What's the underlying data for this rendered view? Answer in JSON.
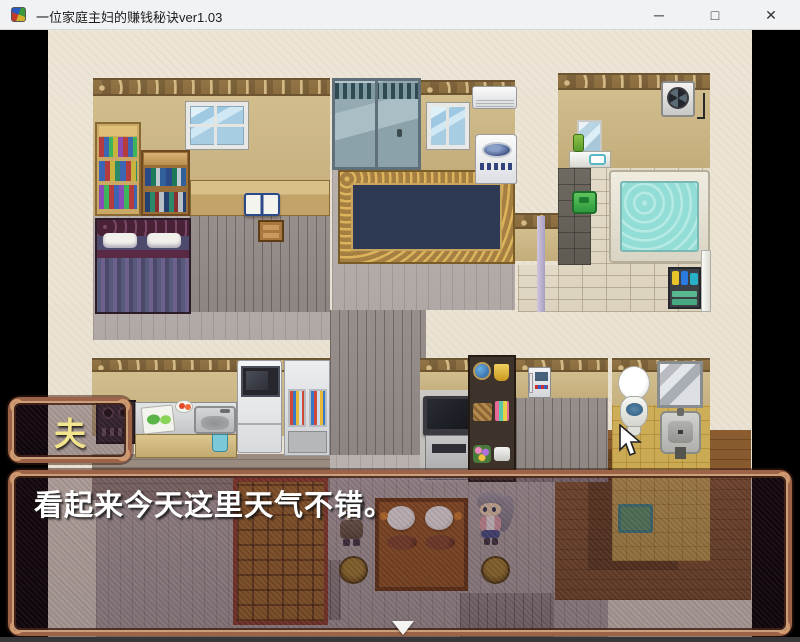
{
  "window": {
    "title": "一位家庭主妇的赚钱秘诀ver1.03",
    "minimize_glyph": "─",
    "maximize_glyph": "□",
    "close_glyph": "✕"
  },
  "dialogue": {
    "speaker": "夫",
    "text": "看起来今天这里天气不错。"
  },
  "theme": {
    "titlebar_bg": "#f1f2f4",
    "dialog_border": "#9c6348",
    "name_text_color": "#f2e48c",
    "message_text_color": "#ffffff",
    "bath_water_color": "#92ded6",
    "carpet_color": "#2e3a54",
    "viewport_letterbox": "#000000"
  },
  "icons": {
    "app_icon": "rpg-maker-cube",
    "continue_indicator": "down-triangle",
    "mouse_cursor": "arrow-pointer",
    "vent_fan": "fan-icon"
  }
}
